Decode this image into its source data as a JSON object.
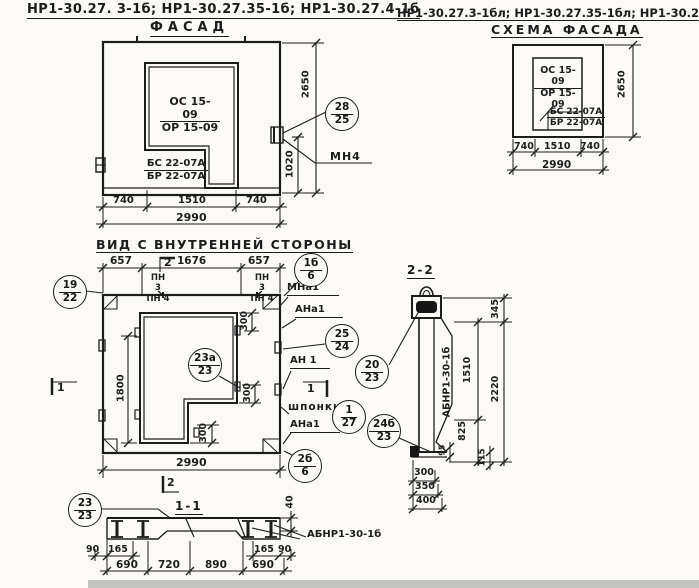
{
  "titles": {
    "series_left": "НР1-30.27. 3-1б;  НР1-30.27.35-1б;  НР1-30.27.4-1б",
    "view_left": "ФАСАД",
    "series_right": "НР1-30.27.3-1бл; НР1-30.27.35-1бл; НР1-30.27.4-1бл",
    "view_right": "СХЕМА ФАСАДА",
    "view_inner": "ВИД С ВНУТРЕННЕЙ СТОРОНЫ",
    "section_22": "2-2",
    "section_11": "1-1"
  },
  "facade": {
    "window_mark_top": "ОС 15-09",
    "window_mark_bot": "ОР 15-09",
    "block_mark_top": "БС 22-07А",
    "block_mark_bot": "БР 22-07А",
    "dim_height": "2650",
    "dim_1020": "1020",
    "dim_w1": "740",
    "dim_w2": "1510",
    "dim_w3": "740",
    "dim_total": "2990",
    "callout_top": "28",
    "callout_bot": "25",
    "label_mn4": "МН4"
  },
  "scheme": {
    "window_mark_top": "ОС 15-09",
    "window_mark_bot": "ОР 15-09",
    "block_mark_top": "БС 22-07А",
    "block_mark_bot": "БР 22-07А",
    "dim_height": "2650",
    "dim_w1": "740",
    "dim_w2": "1510",
    "dim_w3": "740",
    "dim_total": "2990"
  },
  "inner": {
    "dim_w1": "657",
    "dim_w2": "1676",
    "dim_w3": "657",
    "dim_total": "2990",
    "dim_opening": "1800",
    "dim_300a": "300",
    "dim_300b": "300",
    "dim_300c": "300",
    "label_pn3": "ПН 3",
    "label_pn4": "ПН 4",
    "label_mna1": "МНа1",
    "label_ana1": "АНа1",
    "label_an1": "АН 1",
    "label_ana1b": "АНа1",
    "label_shponki": "шпонки",
    "flag_1": "1",
    "flag_2": "2",
    "callouts": {
      "c19_22": {
        "top": "19",
        "bot": "22"
      },
      "c1b_6": {
        "top": "1б",
        "bot": "6"
      },
      "c25_24": {
        "top": "25",
        "bot": "24"
      },
      "c23a_23": {
        "top": "23а",
        "bot": "23"
      },
      "c1_27": {
        "top": "1",
        "bot": "27"
      },
      "c2b_6": {
        "top": "2б",
        "bot": "6"
      },
      "c20_23": {
        "top": "20",
        "bot": "23"
      },
      "c24b_23": {
        "top": "24б",
        "bot": "23"
      }
    }
  },
  "s22": {
    "panel_mark": "АБНР1-30-1б",
    "dim_345": "345",
    "dim_1510": "1510",
    "dim_2220": "2220",
    "dim_825": "825",
    "dim_95": "95",
    "dim_115": "115",
    "dim_300": "300",
    "dim_350": "350",
    "dim_400": "400"
  },
  "s11": {
    "beam_mark": "АБНР1-30-1б",
    "callout_top": "23",
    "callout_bot": "23",
    "dim_40": "40",
    "dim_90l": "90",
    "dim_165l": "165",
    "dim_165r": "165",
    "dim_90r": "90",
    "dim_690a": "690",
    "dim_720": "720",
    "dim_890": "890",
    "dim_690b": "690"
  }
}
